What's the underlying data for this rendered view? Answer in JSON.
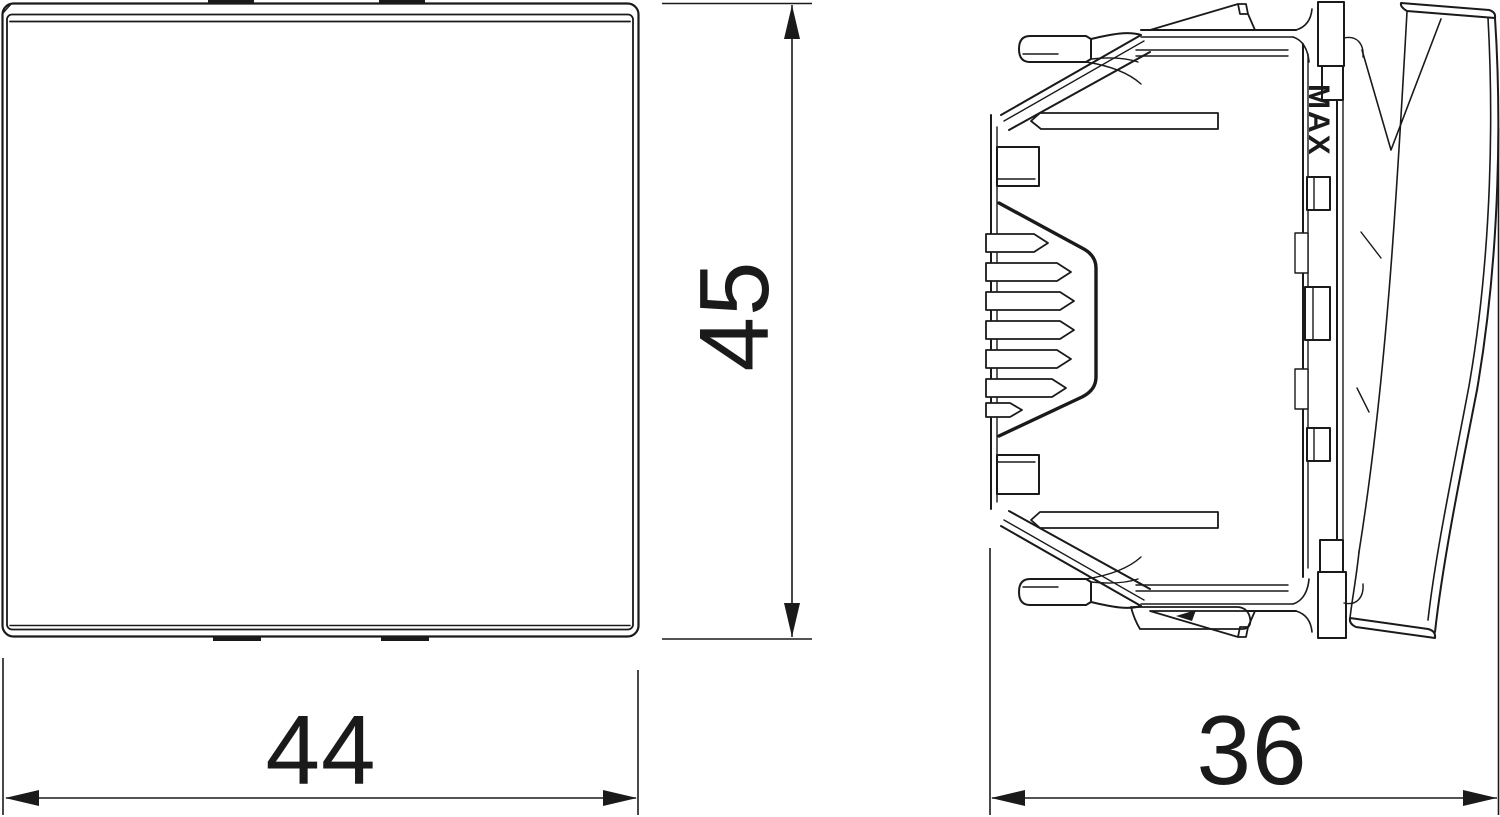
{
  "drawing": {
    "background": "#ffffff",
    "line_color": "#1a1a1a",
    "dimensions": {
      "width": {
        "value": "44"
      },
      "height": {
        "value": "45"
      },
      "depth": {
        "value": "36"
      }
    },
    "side_view": {
      "marking": "MAX"
    }
  }
}
